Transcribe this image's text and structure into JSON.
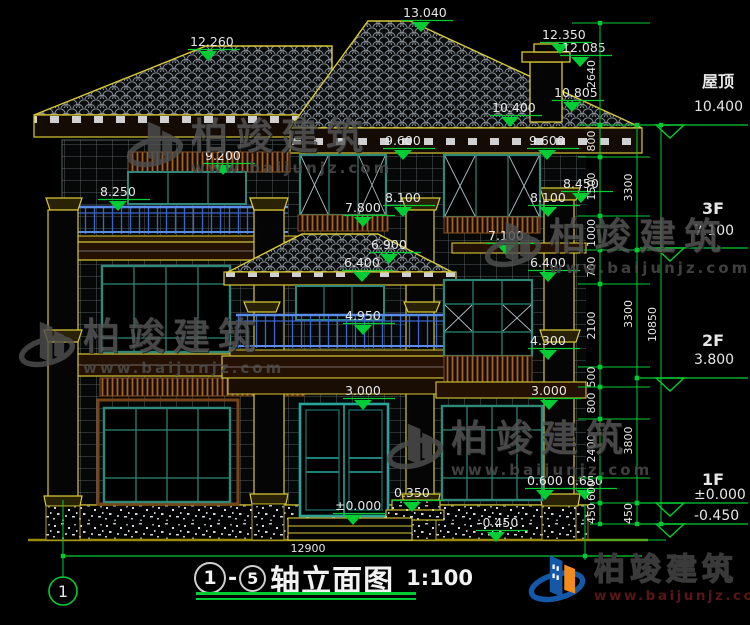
{
  "title": {
    "bubble_left": "1",
    "separator": "-",
    "bubble_right": "5",
    "name": "轴立面图",
    "scale": "1:100"
  },
  "axis_bubble": "1",
  "bottom_dim": "12900",
  "watermark": {
    "name": "柏竣建筑",
    "url": "www.baijunjz.com"
  },
  "logo": {
    "name": "柏竣建筑",
    "url": "www.baijunjz.com"
  },
  "colors": {
    "dim_green": "#00cc33",
    "text_white": "#e6e6e6",
    "trim_yellow": "#d8c838",
    "frame_teal": "#2f8878",
    "railing_blue": "#3a6fd8",
    "band_brown": "#8a5a28",
    "watermark_gray": "#575757",
    "logo_blue": "#1558a8",
    "logo_orange": "#f28a1e"
  },
  "elevation_marks": [
    {
      "t": "12.260",
      "x": 190,
      "y": 46
    },
    {
      "t": "13.040",
      "x": 403,
      "y": 17
    },
    {
      "t": "12.350",
      "x": 542,
      "y": 39
    },
    {
      "t": "12.085",
      "x": 562,
      "y": 52
    },
    {
      "t": "10.805",
      "x": 554,
      "y": 97
    },
    {
      "t": "10.400",
      "x": 492,
      "y": 112
    },
    {
      "t": "9.600",
      "x": 385,
      "y": 145
    },
    {
      "t": "9.600",
      "x": 529,
      "y": 145
    },
    {
      "t": "9.200",
      "x": 205,
      "y": 160
    },
    {
      "t": "8.250",
      "x": 100,
      "y": 196
    },
    {
      "t": "8.450",
      "x": 563,
      "y": 188
    },
    {
      "t": "8.100",
      "x": 385,
      "y": 202
    },
    {
      "t": "8.100",
      "x": 530,
      "y": 202
    },
    {
      "t": "7.800",
      "x": 345,
      "y": 212
    },
    {
      "t": "7.100",
      "x": 488,
      "y": 240
    },
    {
      "t": "6.900",
      "x": 371,
      "y": 249
    },
    {
      "t": "6.400",
      "x": 344,
      "y": 267
    },
    {
      "t": "6.400",
      "x": 530,
      "y": 267
    },
    {
      "t": "4.950",
      "x": 345,
      "y": 320
    },
    {
      "t": "4.300",
      "x": 530,
      "y": 345
    },
    {
      "t": "3.000",
      "x": 345,
      "y": 395
    },
    {
      "t": "3.000",
      "x": 531,
      "y": 395
    },
    {
      "t": "0.600",
      "x": 527,
      "y": 485
    },
    {
      "t": "0.650",
      "x": 567,
      "y": 485
    },
    {
      "t": "0.350",
      "x": 394,
      "y": 497
    },
    {
      "t": "±0.000",
      "x": 335,
      "y": 510
    },
    {
      "t": "-0.450",
      "x": 478,
      "y": 527
    }
  ],
  "dim_chains": [
    {
      "x": 600,
      "segments": [
        {
          "label": "2640",
          "y1": 23,
          "y2": 125
        },
        {
          "label": "800",
          "y1": 125,
          "y2": 157
        },
        {
          "label": "1500",
          "y1": 157,
          "y2": 216
        },
        {
          "label": "1000",
          "y1": 216,
          "y2": 250
        },
        {
          "label": "700",
          "y1": 250,
          "y2": 284
        },
        {
          "label": "2100",
          "y1": 284,
          "y2": 367
        },
        {
          "label": "500",
          "y1": 367,
          "y2": 387
        },
        {
          "label": "800",
          "y1": 387,
          "y2": 419
        },
        {
          "label": "2400",
          "y1": 419,
          "y2": 478
        },
        {
          "label": "600",
          "y1": 478,
          "y2": 503
        },
        {
          "label": "450",
          "y1": 503,
          "y2": 524
        }
      ]
    },
    {
      "x": 637,
      "segments": [
        {
          "label": "3300",
          "y1": 125,
          "y2": 250
        },
        {
          "label": "3300",
          "y1": 250,
          "y2": 378
        },
        {
          "label": "3800",
          "y1": 378,
          "y2": 503
        },
        {
          "label": "450",
          "y1": 503,
          "y2": 524
        }
      ]
    },
    {
      "x": 661,
      "segments": [
        {
          "label": "10850",
          "y1": 125,
          "y2": 524
        }
      ]
    }
  ],
  "floor_levels": [
    {
      "name": "屋顶",
      "elev": "10.400",
      "line_y": 125,
      "name_dy": -38,
      "elev_dy": -14
    },
    {
      "name": "3F",
      "elev": "7.100",
      "line_y": 248,
      "name_dy": -34,
      "elev_dy": -13
    },
    {
      "name": "2F",
      "elev": "3.800",
      "line_y": 378,
      "name_dy": -32,
      "elev_dy": -14
    },
    {
      "name": "1F",
      "elev": "±0.000",
      "line_y": 503,
      "name_dy": -18,
      "elev_dy": -4
    },
    {
      "name": "",
      "elev": "-0.450",
      "line_y": 524,
      "name_dy": 0,
      "elev_dy": -4
    }
  ]
}
